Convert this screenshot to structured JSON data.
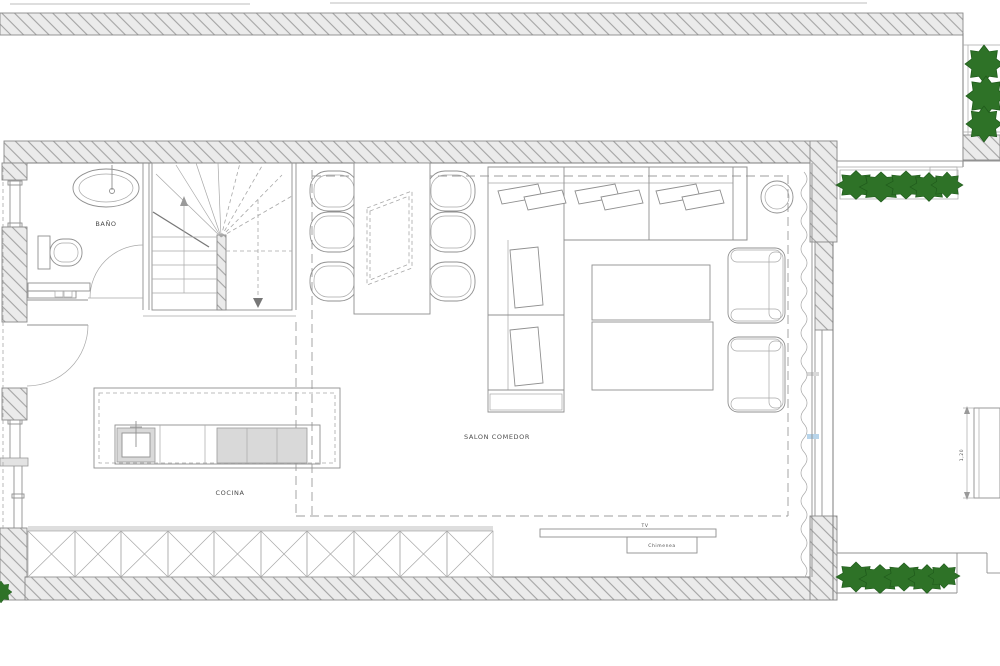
{
  "drawing": {
    "kind": "architectural-floor-plan",
    "style": "CAD line drawing, white background, hatched walls, green landscaping"
  },
  "labels": {
    "bathroom": "BAÑO",
    "kitchen": "COCINA",
    "living_dining": "SALON COMEDOR",
    "tv": "TV",
    "tv_unit_box": "Chimenea",
    "terrace_dimension": "1,20"
  },
  "rooms": [
    {
      "name": "bathroom",
      "label": "BAÑO",
      "furniture": [
        "sink",
        "toilet",
        "cabinet",
        "door-swing"
      ]
    },
    {
      "name": "staircase",
      "furniture": [
        "winder-stairs",
        "up-arrow",
        "down-arrow"
      ]
    },
    {
      "name": "kitchen",
      "label": "COCINA",
      "furniture": [
        "island-with-sink-and-cooktop",
        "base-cabinet-run"
      ]
    },
    {
      "name": "living-dining",
      "label": "SALON COMEDOR",
      "furniture": [
        "dining-table",
        "six-chairs",
        "corner-sofa",
        "two-coffee-tables",
        "two-armchairs",
        "round-side-table",
        "tv-console"
      ]
    },
    {
      "name": "terrace",
      "furniture": [
        "hedge-planters",
        "outdoor-table"
      ]
    }
  ],
  "colors": {
    "background": "#ffffff",
    "wall-fill": "#ebebeb",
    "hatch-line": "#a3a3a3",
    "line-strong": "#7d7d7d",
    "line-medium": "#909090",
    "line-light": "#a8a8a8",
    "dash-line": "#9c9c9c",
    "appliance-gray": "#d9d9d9",
    "plant-green": "#2e7227",
    "plant-green-dark": "#1f5a1b",
    "label-text": "#4c4c4c",
    "glass-blue": "#b7d4ea"
  }
}
